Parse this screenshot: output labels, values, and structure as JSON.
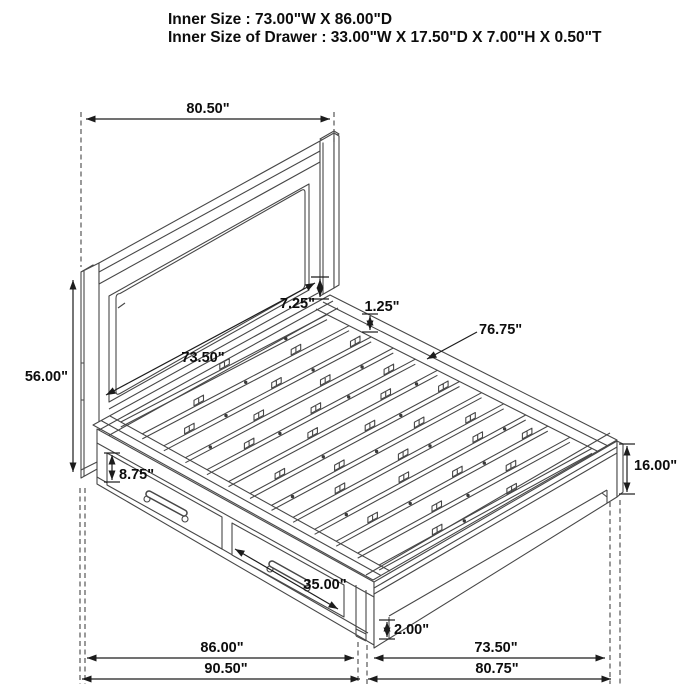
{
  "title": {
    "line1": "Inner Size : 73.00\"W X 86.00\"D",
    "line2": "Inner Size of Drawer : 33.00\"W X 17.50\"D X 7.00\"H X 0.50\"T"
  },
  "dimensions": {
    "headboard_width": "80.50\"",
    "headboard_height": "56.00\"",
    "headboard_inner_width": "73.50\"",
    "headboard_rail_gap": "7.25\"",
    "slat_lip_thickness": "1.25\"",
    "slat_length": "76.75\"",
    "footboard_leg_height": "16.00\"",
    "drawer_front_height": "8.75\"",
    "drawer_front_width": "35.00\"",
    "foot_rail_clearance": "2.00\"",
    "side_inner_depth": "86.00\"",
    "overall_depth": "90.50\"",
    "foot_inner_width": "73.50\"",
    "foot_overall_width": "80.75\""
  },
  "colors": {
    "background": "#ffffff",
    "drawing_line": "#474747",
    "dimension_line": "#1c1c1c",
    "label_text": "#0d0d0d"
  }
}
